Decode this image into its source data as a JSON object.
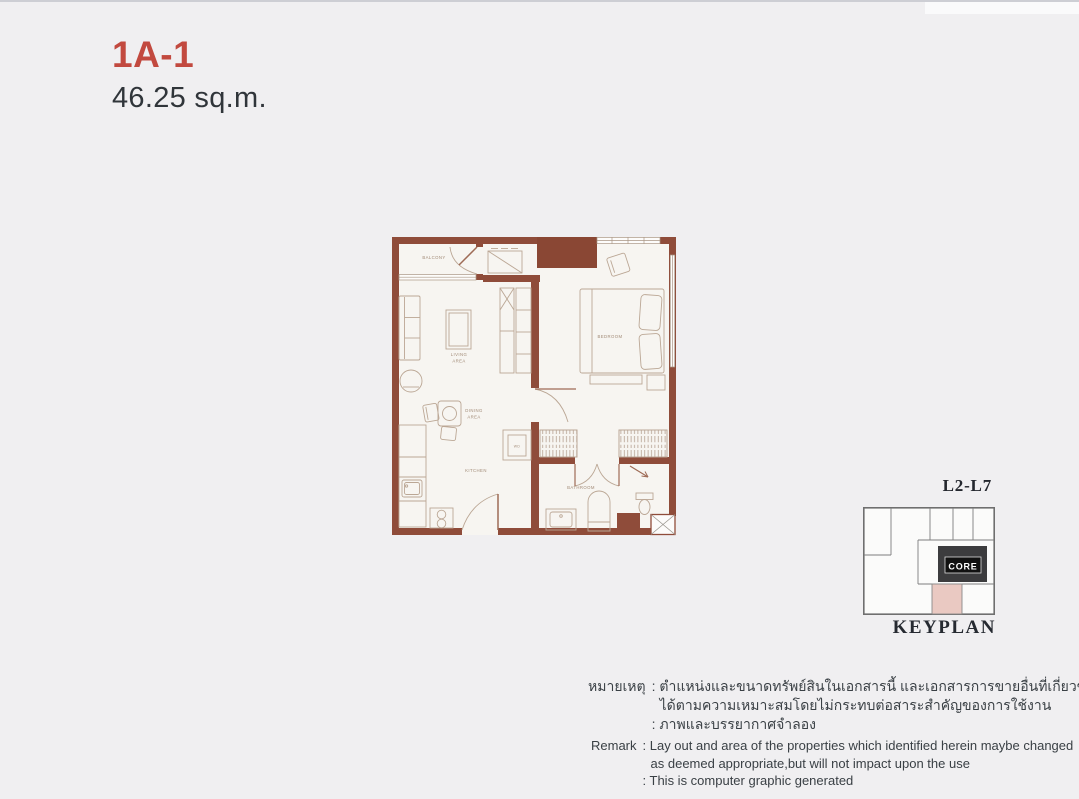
{
  "unit": {
    "code": "1A-1",
    "area": "46.25 sq.m.",
    "code_color": "#c2493f"
  },
  "floorplan": {
    "labels": {
      "balcony": "BALCONY",
      "living_line1": "LIVING",
      "living_line2": "AREA",
      "dining_line1": "DINING",
      "dining_line2": "AREA",
      "kitchen": "KITCHEN",
      "bathroom": "BATHROOM",
      "bedroom": "BEDROOM",
      "wd": "WD"
    },
    "colors": {
      "wall": "#8f4c3a",
      "furniture": "#bba795",
      "label_text": "#a28b77"
    }
  },
  "keyplan": {
    "floors": "L2-L7",
    "title": "KEYPLAN",
    "core_label": "CORE",
    "colors": {
      "core_block": "#3c3c3e",
      "highlight_unit": "#eac9c2",
      "outline": "#6f6f6f"
    }
  },
  "remarks": {
    "thai": {
      "label": "หมายเหตุ",
      "lines": [
        ": ตำแหน่งและขนาดทรัพย์สินในเอกสารนี้ และเอกสารการขายอื่นที่เกี่ยวข้องอาจปรับเปลี่ยน",
        "ได้ตามความเหมาะสมโดยไม่กระทบต่อสาระสำคัญของการใช้งาน",
        ": ภาพและบรรยากาศจำลอง"
      ]
    },
    "english": {
      "label": "Remark",
      "lines": [
        ": Lay out and area of the properties which identified herein maybe changed",
        "as deemed appropriate,but will not impact upon the use",
        ": This is computer graphic generated"
      ]
    }
  }
}
